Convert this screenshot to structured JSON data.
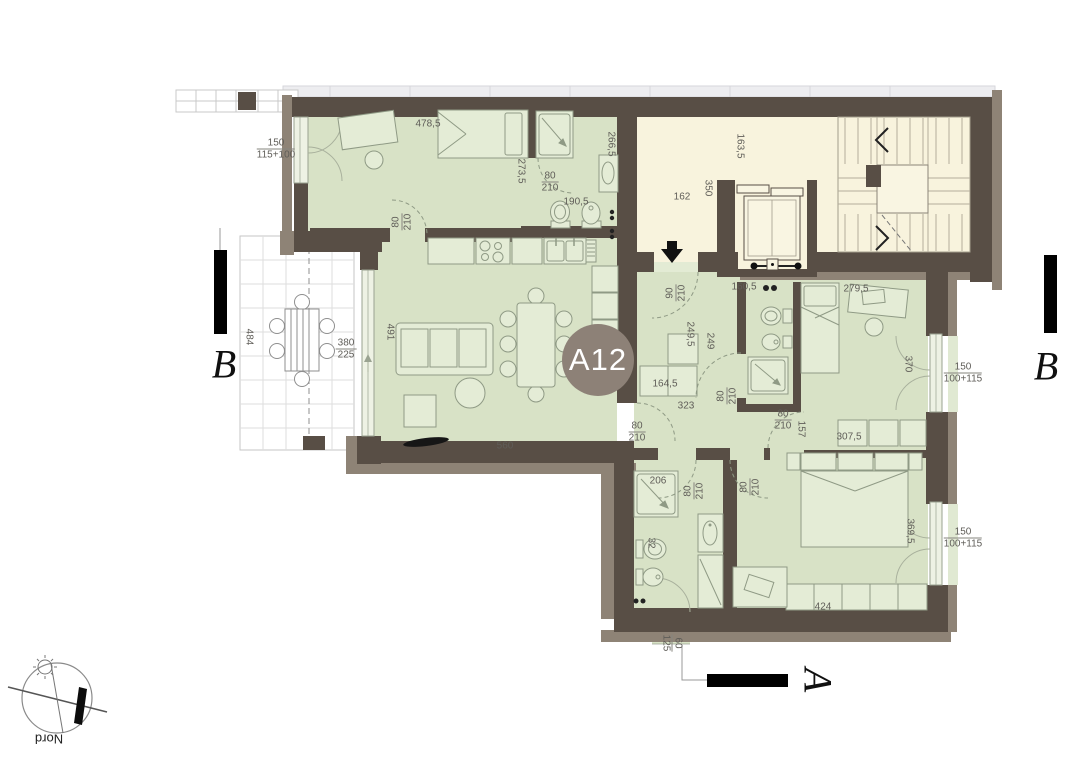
{
  "badge": {
    "label": "A12"
  },
  "sections": {
    "left": "B",
    "right": "B",
    "bottom": "A"
  },
  "compass": {
    "label": "Nord"
  },
  "palette": {
    "wall": "#584e45",
    "wall_outer": "#8e8376",
    "floor": "#d8e2c6",
    "common": "#f8f3dd",
    "badge": "#8d8177",
    "terrace": "#ffffff"
  },
  "dims": {
    "bed1_width": "478,5",
    "win_left_top": "150",
    "win_left_bot": "115+100",
    "bath1_len": "266,5",
    "bed1_depth": "273,5",
    "door_a_top": "80",
    "door_a_bot": "210",
    "bath1_width": "190,5",
    "door_b_top": "80",
    "door_b_bot": "210",
    "hall_len": "163,5",
    "hall_width": "162",
    "hall_depth": "350",
    "door_entry_top": "90",
    "door_entry_bot": "210",
    "corr_top": "160,5",
    "bed2_width": "279,5",
    "corr_len": "249,5",
    "corr_len2": "249",
    "cab_len": "164,5",
    "corr_bot": "323",
    "door_c_top": "80",
    "door_c_bot": "210",
    "door_d_top": "80",
    "door_d_bot": "210",
    "door_e_top": "80",
    "door_e_bot": "210",
    "door_e_w": "157",
    "door_f_top": "80",
    "door_f_bot": "210",
    "door_g_top": "80",
    "door_g_bot": "210",
    "bed2_cab": "307,5",
    "win_r1_h": "370",
    "win_r1_top": "150",
    "win_r1_bot": "100+115",
    "living_width": "560",
    "living_len": "491",
    "terr_door_top": "380",
    "terr_door_bot": "225",
    "terr_len": "484",
    "shower2_w": "206",
    "bath2_w": "32",
    "wardrobe_w": "424",
    "bed3_depth": "369,5",
    "win_r2_top": "150",
    "win_r2_bot": "100+115",
    "win_bot_top": "60",
    "win_bot_bot": "125"
  }
}
